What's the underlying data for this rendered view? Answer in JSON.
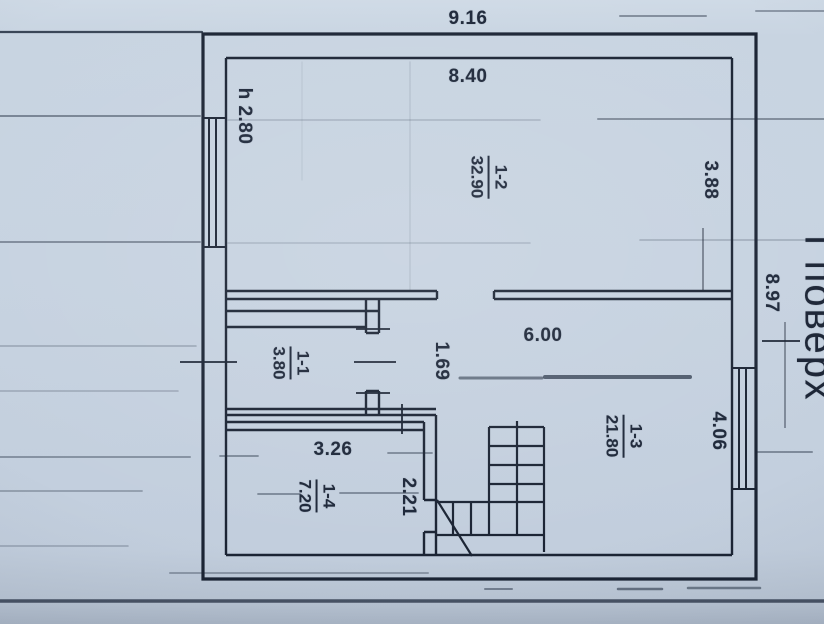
{
  "plan": {
    "floor_label": "І поверх",
    "dims": {
      "top_overall": "9.16",
      "top_inner": "8.40",
      "ceiling_height": "h 2.80",
      "right_upper": "3.88",
      "right_overall": "8.97",
      "hall_width": "6.00",
      "right_lower": "4.06",
      "niche_width": "1.69",
      "room14_width": "3.26",
      "corridor_width": "2.21"
    },
    "rooms": [
      {
        "id": "1-1",
        "area": "3.80"
      },
      {
        "id": "1-2",
        "area": "32.90"
      },
      {
        "id": "1-3",
        "area": "21.80"
      },
      {
        "id": "1-4",
        "area": "7.20"
      }
    ]
  }
}
